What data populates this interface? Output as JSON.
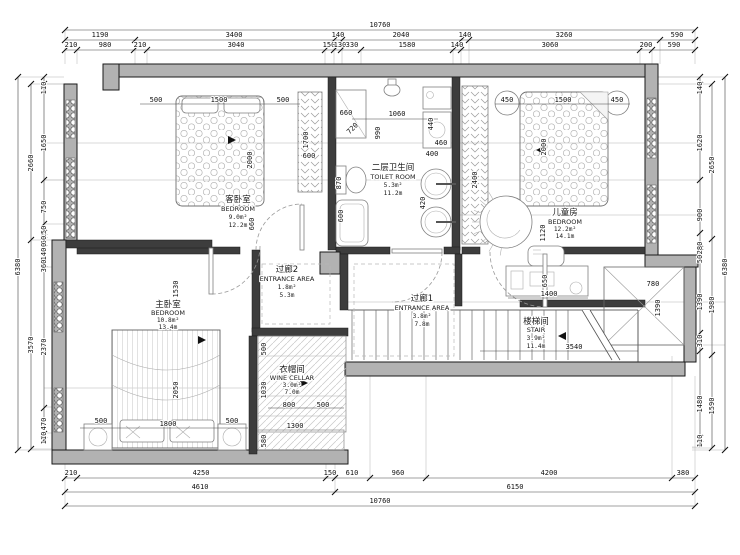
{
  "meta": {
    "drawing_type": "residential floor plan (second storey)"
  },
  "colors": {
    "wall_fill": "#b2b2b2",
    "line": "#1a1a1a",
    "dim": "#111111",
    "background": "#ffffff"
  },
  "rooms": {
    "guest": {
      "cn": "客卧室",
      "en": "BEDROOM",
      "area": "9.0m²",
      "perimeter": "12.2m"
    },
    "toilet": {
      "cn": "二层卫生间",
      "en": "TOILET ROOM",
      "area": "5.3m²",
      "perimeter": "11.2m"
    },
    "kids": {
      "cn": "儿童房",
      "en": "BEDROOM",
      "area": "12.2m²",
      "perimeter": "14.1m"
    },
    "hall2": {
      "cn": "过廊2",
      "en": "ENTRANCE AREA",
      "area": "1.8m²",
      "perimeter": "5.3m"
    },
    "hall1": {
      "cn": "过廊1",
      "en": "ENTRANCE AREA",
      "area": "3.8m²",
      "perimeter": "7.8m"
    },
    "master": {
      "cn": "主卧室",
      "en": "BEDROOM",
      "area": "10.8m²",
      "perimeter": "13.4m"
    },
    "cloak": {
      "cn": "衣帽间",
      "en": "WINE CELLAR",
      "area": "3.0m²",
      "perimeter": "7.0m"
    },
    "stair": {
      "cn": "楼梯间",
      "en": "STAIR",
      "area": "3.9m²",
      "perimeter": "11.4m"
    }
  },
  "dims": {
    "top": {
      "total": "10760",
      "row2": [
        "1190",
        "3400",
        "140",
        "2040",
        "140",
        "3260",
        "590"
      ],
      "row3": [
        "210",
        "980",
        "210",
        "3040",
        "150",
        "130",
        "330",
        "1580",
        "140",
        "3060",
        "200",
        "590"
      ]
    },
    "bottom": {
      "row1": [
        "210",
        "4250",
        "150",
        "610",
        "960",
        "4200",
        "380"
      ],
      "row2": [
        "4610",
        "6150"
      ],
      "total": "10760"
    },
    "left": {
      "outer": "6380",
      "mid": [
        "2660",
        "3570"
      ],
      "inner": [
        "110",
        "1650",
        "750",
        "150",
        "50",
        "30",
        "140",
        "360",
        "2370",
        "470",
        "110"
      ]
    },
    "right": {
      "outer": "6380",
      "mid": [
        "2650",
        "1980",
        "1590"
      ],
      "inner": [
        "140",
        "1620",
        "900",
        "280",
        "50",
        "1390",
        "310",
        "1480",
        "110"
      ]
    },
    "interior": [
      "500",
      "1500",
      "500",
      "2000",
      "660",
      "1700",
      "600",
      "660",
      "720",
      "1060",
      "990",
      "440",
      "460",
      "870",
      "600",
      "400",
      "420",
      "450",
      "1500",
      "450",
      "2000",
      "2400",
      "1120",
      "1530",
      "2050",
      "500",
      "1800",
      "500",
      "500",
      "1030",
      "800",
      "500",
      "1300",
      "580",
      "3540",
      "650",
      "1400",
      "780",
      "1390"
    ]
  }
}
